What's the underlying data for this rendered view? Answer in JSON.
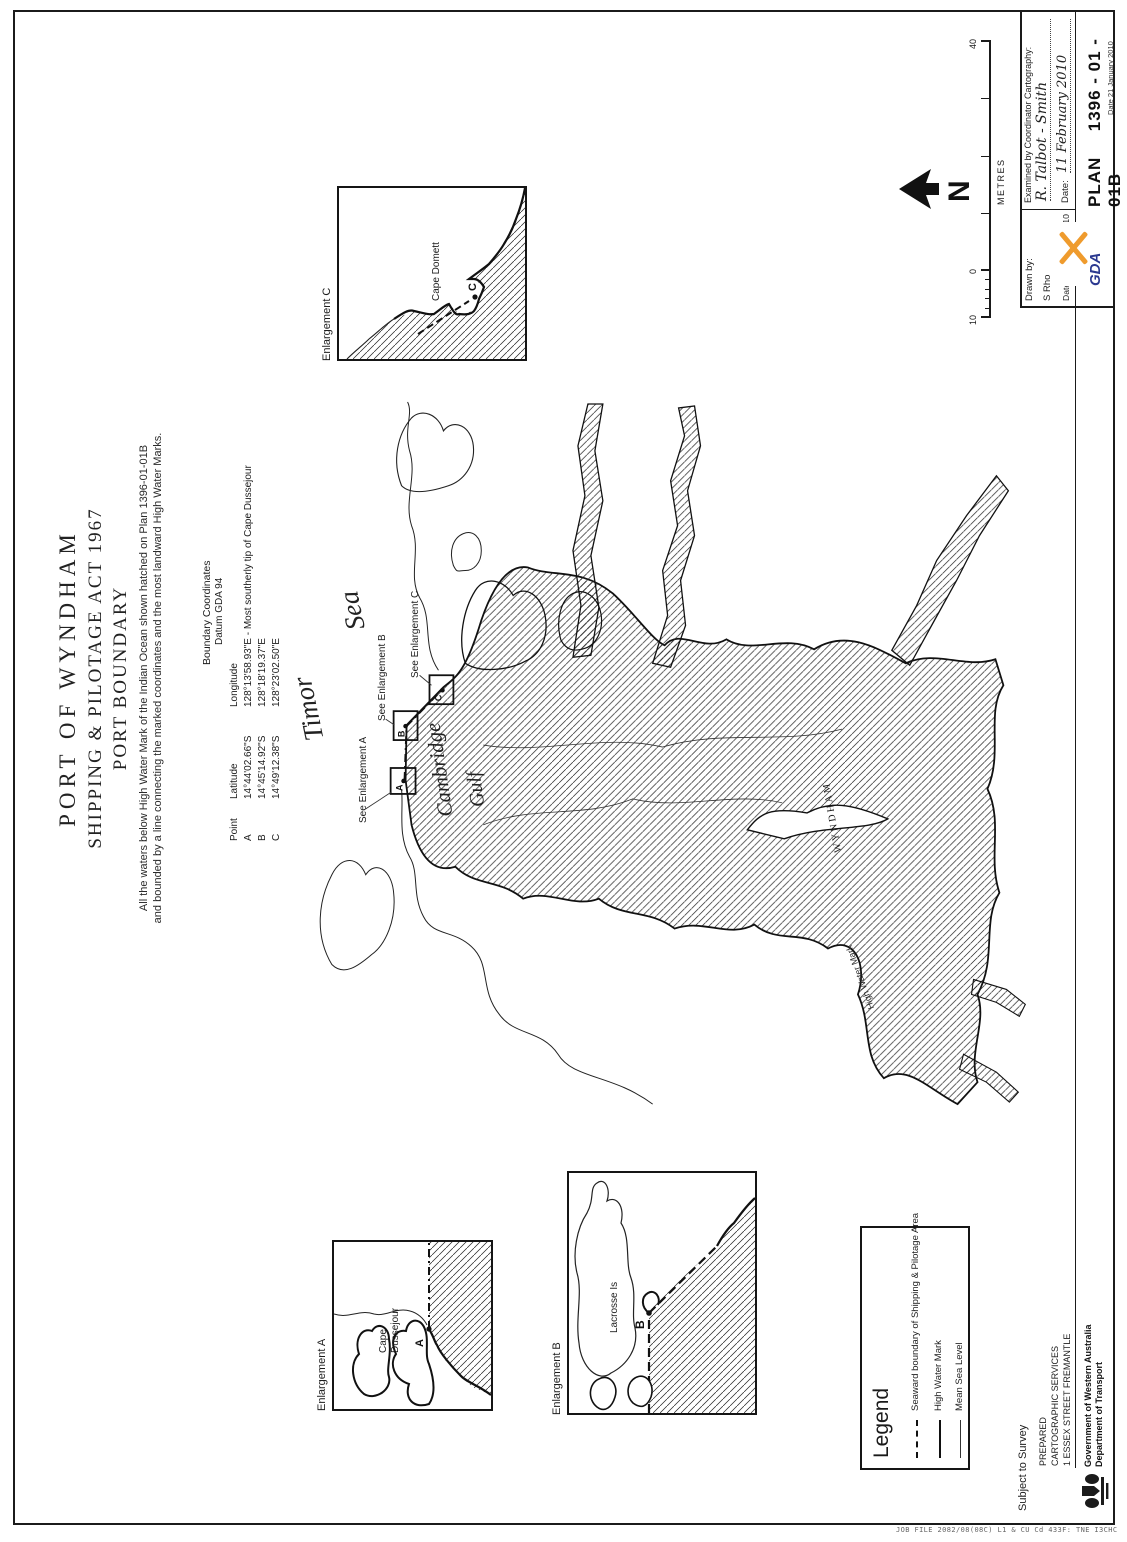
{
  "title": {
    "line1": "PORT OF WYNDHAM",
    "line2": "SHIPPING & PILOTAGE ACT 1967",
    "line3": "PORT BOUNDARY"
  },
  "description": {
    "line1": "All the waters below High Water Mark of the Indian Ocean shown hatched on Plan 1396-01-01B",
    "line2": "and bounded by a line connecting the marked coordinates and the most landward High Water Marks."
  },
  "coordinates": {
    "heading": "Boundary Coordinates",
    "datum": "Datum GDA 94",
    "col_point": "Point",
    "col_latitude": "Latitude",
    "col_longitude": "Longitude",
    "rows": [
      {
        "point": "A",
        "latitude": "14°44'02.66\"S",
        "longitude": "128°13'58.93\"E - Most southerly tip of Cape Dussejour"
      },
      {
        "point": "B",
        "latitude": "14°45'14.92\"S",
        "longitude": "128°18'19.37\"E"
      },
      {
        "point": "C",
        "latitude": "14°49'12.38\"S",
        "longitude": "128°23'02.50\"E"
      }
    ]
  },
  "map": {
    "sea_word1": "Timor",
    "sea_word2": "Sea",
    "gulf_word1": "Cambridge",
    "gulf_word2": "Gulf",
    "town": "WYNDHAM",
    "hwm": "High Water Mark",
    "see_a": "See Enlargement A",
    "see_b": "See Enlargement B",
    "see_c": "See Enlargement C",
    "point_a": "A",
    "point_b": "B",
    "point_c": "C"
  },
  "enlargements": {
    "a": {
      "label": "Enlargement A",
      "feature1": "Cape",
      "feature2": "Dussejour",
      "point": "A"
    },
    "b": {
      "label": "Enlargement B",
      "feature1": "Lacrosse Is",
      "point": "B"
    },
    "c": {
      "label": "Enlargement C",
      "feature1": "Cape Domett",
      "point": "C"
    }
  },
  "legend": {
    "heading": "Legend",
    "items": [
      {
        "label": "Seaward boundary of Shipping & Pilotage Area"
      },
      {
        "label": "High Water Mark"
      },
      {
        "label": "Mean Sea Level"
      }
    ]
  },
  "scalebar": {
    "left_num": "10",
    "zero_num": "0",
    "right_num": "40",
    "units": "METRES"
  },
  "north": {
    "letter": "N"
  },
  "titleblock": {
    "drawn_label": "Drawn by:",
    "drawn_name": "S Rho",
    "drawn_date": "Date: 21 January 2010",
    "examined_label": "Examined by Coordinator Cartography:",
    "examined_signature": "R. Talbot - Smith",
    "examined_date_label": "Date:",
    "examined_date": "11 February 2010",
    "plan_word": "PLAN",
    "plan_number": "1396 - 01 - 01B",
    "plan_date": "Date 21 January 2010",
    "gda": "GDA"
  },
  "footer": {
    "subject": "Subject to Survey",
    "prepared1": "PREPARED",
    "prepared2": "CARTOGRAPHIC SERVICES",
    "prepared3": "1 ESSEX STREET FREMANTLE",
    "gov1": "Government of Western Australia",
    "gov2": "Department of Transport",
    "microprint": "JOB FILE 2082/08(08C)  L1 & CU Cd 433F: TNE I3CHC"
  },
  "colors": {
    "accent_orange": "#ef9b2d",
    "accent_blue": "#2b3990",
    "ink": "#1b1b1b"
  }
}
